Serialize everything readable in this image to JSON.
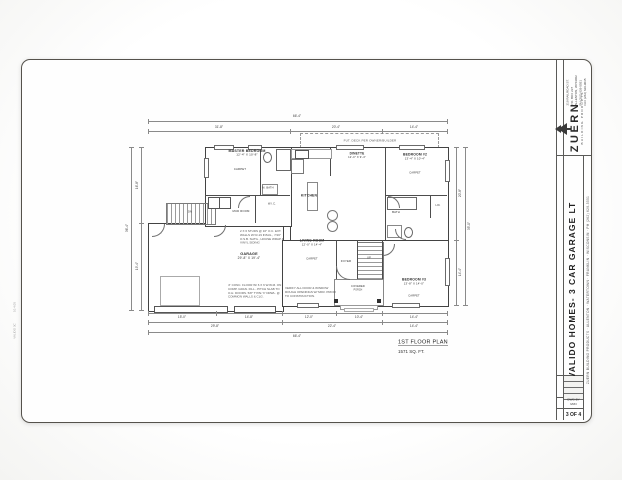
{
  "title_block": {
    "company": {
      "name": "ZUERN",
      "tagline": "BUILDING PRODUCTS",
      "address_lines": [
        "219 RAILROAD ST.",
        "P.O. BOX 237",
        "ALLENTON, WI 53002",
        "PH (262) 629-5551",
        "FAX (262) 629-9035"
      ]
    },
    "project_title": "VALIDO HOMES- 3 CAR GARAGE LT",
    "info_line": "ZUERN BUILDING PRODUCTS · ALLENTON · WATERTOWN · FRANKLIN · WISCONSIN · PH (262) 629-5551",
    "table_rows": [
      "DRAWN: MJN",
      "DATE: 8-05",
      "SCALE: 1/4\" = 1'-0\"",
      "JOB NO: 05-213"
    ],
    "dwg_by_label": "DWG BY",
    "dwg_by_value": "MJN",
    "sheet_number": "3 OF 4"
  },
  "edge_stamps": [
    {
      "text": "10.4.05",
      "x": 15,
      "y": 307
    },
    {
      "text": "VALIDO 3C",
      "x": 15,
      "y": 331
    }
  ],
  "plan": {
    "caption": {
      "title": "1ST FLOOR PLAN",
      "subtitle": "1571 SQ. FT."
    },
    "deck_label": "FUT. DECK PER OWNER/BUILDER",
    "outlines": [
      {
        "x": 148,
        "y": 223,
        "w": 134,
        "h": 87
      },
      {
        "x": 290,
        "y": 147,
        "w": 157,
        "h": 93
      },
      {
        "x": 282,
        "y": 240,
        "w": 165,
        "h": 65
      },
      {
        "x": 205,
        "y": 147,
        "w": 85,
        "h": 78
      }
    ],
    "walls": [
      {
        "x": 330,
        "y": 148,
        "w": 1,
        "h": 28
      },
      {
        "x": 385,
        "y": 148,
        "w": 1,
        "h": 92
      },
      {
        "x": 386,
        "y": 195,
        "w": 61,
        "h": 1
      },
      {
        "x": 430,
        "y": 196,
        "w": 1,
        "h": 22
      },
      {
        "x": 336,
        "y": 240,
        "w": 1,
        "h": 40
      },
      {
        "x": 357,
        "y": 240,
        "w": 1,
        "h": 40
      },
      {
        "x": 382,
        "y": 240,
        "w": 1,
        "h": 65
      },
      {
        "x": 205,
        "y": 195,
        "w": 85,
        "h": 1
      },
      {
        "x": 255,
        "y": 196,
        "w": 1,
        "h": 27
      },
      {
        "x": 260,
        "y": 148,
        "w": 1,
        "h": 47
      }
    ],
    "stairs": [
      {
        "x": 166,
        "y": 203,
        "w": 48,
        "h": 20,
        "dir": 90
      },
      {
        "x": 357,
        "y": 242,
        "w": 25,
        "h": 36,
        "dir": 0
      }
    ],
    "windows": [
      {
        "x": 214,
        "y": 145,
        "w": 18,
        "h": 3
      },
      {
        "x": 248,
        "y": 145,
        "w": 12,
        "h": 3
      },
      {
        "x": 336,
        "y": 145,
        "w": 26,
        "h": 3
      },
      {
        "x": 399,
        "y": 145,
        "w": 24,
        "h": 3
      },
      {
        "x": 445,
        "y": 160,
        "w": 3,
        "h": 20
      },
      {
        "x": 445,
        "y": 258,
        "w": 3,
        "h": 26
      },
      {
        "x": 297,
        "y": 303,
        "w": 20,
        "h": 3
      },
      {
        "x": 392,
        "y": 303,
        "w": 26,
        "h": 3
      },
      {
        "x": 204,
        "y": 158,
        "w": 3,
        "h": 18
      }
    ],
    "doors": [
      {
        "x": 152,
        "y": 224,
        "s": 12,
        "c": "br"
      },
      {
        "x": 336,
        "y": 266,
        "s": 13,
        "c": "bl"
      },
      {
        "x": 238,
        "y": 196,
        "s": 11,
        "c": "tl"
      },
      {
        "x": 388,
        "y": 196,
        "s": 11,
        "c": "tr"
      },
      {
        "x": 383,
        "y": 244,
        "s": 11,
        "c": "br"
      },
      {
        "x": 395,
        "y": 229,
        "s": 10,
        "c": "bl"
      },
      {
        "x": 214,
        "y": 225,
        "s": 11,
        "c": "br"
      }
    ],
    "fixtures": [
      {
        "k": "rect",
        "x": 291,
        "y": 149,
        "w": 39,
        "h": 8,
        "c": "#999"
      },
      {
        "k": "rect",
        "x": 295,
        "y": 150,
        "w": 12,
        "h": 7,
        "c": "#555"
      },
      {
        "k": "rect",
        "x": 291,
        "y": 159,
        "w": 11,
        "h": 13,
        "c": "#777"
      },
      {
        "k": "rect",
        "x": 307,
        "y": 182,
        "w": 9,
        "h": 27,
        "c": "#888"
      },
      {
        "k": "circ",
        "x": 327,
        "y": 210,
        "w": 9,
        "h": 9,
        "c": "#777"
      },
      {
        "k": "circ",
        "x": 327,
        "y": 221,
        "w": 9,
        "h": 9,
        "c": "#777"
      },
      {
        "k": "rect",
        "x": 276,
        "y": 149,
        "w": 13,
        "h": 20,
        "c": "#666"
      },
      {
        "k": "circ",
        "x": 263,
        "y": 152,
        "w": 7,
        "h": 9,
        "c": "#666"
      },
      {
        "k": "rect",
        "x": 262,
        "y": 184,
        "w": 14,
        "h": 9,
        "c": "#888"
      },
      {
        "k": "rect",
        "x": 387,
        "y": 197,
        "w": 28,
        "h": 11,
        "c": "#666"
      },
      {
        "k": "rect",
        "x": 387,
        "y": 225,
        "w": 13,
        "h": 11,
        "c": "#888"
      },
      {
        "k": "circ",
        "x": 404,
        "y": 227,
        "w": 7,
        "h": 9,
        "c": "#666"
      },
      {
        "k": "rect",
        "x": 208,
        "y": 197,
        "w": 10,
        "h": 10,
        "c": "#555"
      },
      {
        "k": "rect",
        "x": 219,
        "y": 197,
        "w": 10,
        "h": 10,
        "c": "#555"
      },
      {
        "k": "rect",
        "x": 160,
        "y": 276,
        "w": 38,
        "h": 28,
        "c": "#aaa"
      },
      {
        "k": "rect",
        "x": 334,
        "y": 279,
        "w": 48,
        "h": 25,
        "c": "#888"
      },
      {
        "k": "rect",
        "x": 340,
        "y": 305,
        "w": 36,
        "h": 3,
        "c": "#999"
      },
      {
        "k": "rect",
        "x": 344,
        "y": 308,
        "w": 28,
        "h": 2,
        "c": "#aaa"
      },
      {
        "k": "rect",
        "x": 154,
        "y": 306,
        "w": 72,
        "h": 5,
        "c": "#555"
      },
      {
        "k": "rect",
        "x": 234,
        "y": 306,
        "w": 40,
        "h": 5,
        "c": "#555"
      }
    ],
    "posts": [
      {
        "x": 334,
        "y": 299
      },
      {
        "x": 377,
        "y": 299
      }
    ],
    "labels": [
      {
        "x": 247,
        "y": 153,
        "fs": 3.6,
        "b": 1,
        "l": [
          "MASTER BEDROOM",
          "12'-4\" X 10'-8\""
        ]
      },
      {
        "x": 240,
        "y": 170,
        "fs": 2.8,
        "l": [
          "CARPET"
        ]
      },
      {
        "x": 268,
        "y": 188,
        "fs": 2.6,
        "l": [
          "M. BATH"
        ]
      },
      {
        "x": 272,
        "y": 204,
        "fs": 2.6,
        "l": [
          "W.I.C."
        ]
      },
      {
        "x": 241,
        "y": 212,
        "fs": 2.8,
        "l": [
          "MUD ROOM"
        ]
      },
      {
        "x": 309,
        "y": 196,
        "fs": 3.4,
        "b": 1,
        "l": [
          "KITCHEN"
        ]
      },
      {
        "x": 357,
        "y": 156,
        "fs": 3.2,
        "b": 1,
        "l": [
          "DINETTE",
          "12'-0\" X 9'-4\""
        ]
      },
      {
        "x": 415,
        "y": 157,
        "fs": 3.4,
        "b": 1,
        "l": [
          "BEDROOM #2",
          "13'-4\" X 10'-4\""
        ]
      },
      {
        "x": 415,
        "y": 173,
        "fs": 2.6,
        "l": [
          "CARPET"
        ]
      },
      {
        "x": 396,
        "y": 213,
        "fs": 2.8,
        "l": [
          "BATH"
        ]
      },
      {
        "x": 438,
        "y": 206,
        "fs": 2.4,
        "l": [
          "LIN."
        ]
      },
      {
        "x": 312,
        "y": 243,
        "fs": 3.4,
        "b": 1,
        "l": [
          "LIVING ROOM",
          "12'-0\" X 14'-4\""
        ]
      },
      {
        "x": 312,
        "y": 259,
        "fs": 2.6,
        "l": [
          "CARPET"
        ]
      },
      {
        "x": 346,
        "y": 262,
        "fs": 2.8,
        "l": [
          "FOYER"
        ]
      },
      {
        "x": 369,
        "y": 258,
        "fs": 2.6,
        "l": [
          "UP"
        ]
      },
      {
        "x": 414,
        "y": 282,
        "fs": 3.4,
        "b": 1,
        "l": [
          "BEDROOM #3",
          "13'-8\" X 14'-0\""
        ]
      },
      {
        "x": 414,
        "y": 296,
        "fs": 2.6,
        "l": [
          "CARPET"
        ]
      },
      {
        "x": 358,
        "y": 288,
        "fs": 2.6,
        "l": [
          "COVERED",
          "PORCH"
        ]
      },
      {
        "x": 249,
        "y": 256,
        "fs": 3.8,
        "b": 1,
        "l": [
          "GARAGE",
          "29'-8\" X 19'-4\""
        ]
      },
      {
        "x": 190,
        "y": 212,
        "fs": 2.6,
        "l": [
          "DN"
        ]
      }
    ],
    "notes": [
      {
        "x": 240,
        "y": 230,
        "w": 44,
        "t": "2 X 6 STUDS @ 16\" O.C. EXT. WALLS W/ R-19 INSUL., 7/16\" O.S.B. SHTG., HOUSE WRAP & VINYL SIDING"
      },
      {
        "x": 228,
        "y": 284,
        "w": 54,
        "t": "4\" CONC. FLOOR W/ 6 X 6 W.W.M. ON COMP. GRAN. FILL - PITCH SLAB TO O.H. DOORS. 5/8\" TYPE 'X' DRWL. @ COMMON WALLS & CLG."
      },
      {
        "x": 285,
        "y": 287,
        "w": 52,
        "t": "VERIFY ALL DOOR & WINDOW ROUGH OPENINGS W/ MFR. PRIOR TO CONSTRUCTION."
      }
    ],
    "dims": [
      {
        "o": "h",
        "a": 148,
        "b": 447,
        "p": 121,
        "t": "66'-4\"",
        "lx": 297,
        "ly": 116
      },
      {
        "o": "h",
        "a": 148,
        "b": 290,
        "p": 131,
        "t": "31'-8\"",
        "lx": 219,
        "ly": 127
      },
      {
        "o": "h",
        "a": 290,
        "b": 382,
        "p": 131,
        "t": "20'-4\"",
        "lx": 336,
        "ly": 127
      },
      {
        "o": "h",
        "a": 382,
        "b": 447,
        "p": 131,
        "t": "14'-4\"",
        "lx": 414,
        "ly": 127
      },
      {
        "o": "h",
        "a": 148,
        "b": 216,
        "p": 313,
        "t": "15'-0\"",
        "lx": 182,
        "ly": 317
      },
      {
        "o": "h",
        "a": 216,
        "b": 282,
        "p": 313,
        "t": "14'-8\"",
        "lx": 249,
        "ly": 317
      },
      {
        "o": "h",
        "a": 282,
        "b": 336,
        "p": 313,
        "t": "12'-0\"",
        "lx": 309,
        "ly": 317
      },
      {
        "o": "h",
        "a": 336,
        "b": 382,
        "p": 313,
        "t": "10'-4\"",
        "lx": 359,
        "ly": 317
      },
      {
        "o": "h",
        "a": 382,
        "b": 447,
        "p": 313,
        "t": "14'-4\"",
        "lx": 414,
        "ly": 317
      },
      {
        "o": "h",
        "a": 148,
        "b": 282,
        "p": 322,
        "t": "29'-8\"",
        "lx": 215,
        "ly": 326
      },
      {
        "o": "h",
        "a": 282,
        "b": 382,
        "p": 322,
        "t": "22'-4\"",
        "lx": 332,
        "ly": 326
      },
      {
        "o": "h",
        "a": 382,
        "b": 447,
        "p": 322,
        "t": "14'-4\"",
        "lx": 414,
        "ly": 326
      },
      {
        "o": "h",
        "a": 148,
        "b": 447,
        "p": 332,
        "t": "66'-4\"",
        "lx": 297,
        "ly": 336
      },
      {
        "o": "v",
        "a": 147,
        "b": 223,
        "p": 141,
        "t": "16'-8\"",
        "lx": 137,
        "ly": 185
      },
      {
        "o": "v",
        "a": 223,
        "b": 310,
        "p": 141,
        "t": "19'-4\"",
        "lx": 137,
        "ly": 266
      },
      {
        "o": "v",
        "a": 147,
        "b": 310,
        "p": 131,
        "t": "36'-4\"",
        "lx": 127,
        "ly": 228
      },
      {
        "o": "v",
        "a": 147,
        "b": 240,
        "p": 456,
        "t": "20'-8\"",
        "lx": 460,
        "ly": 193
      },
      {
        "o": "v",
        "a": 240,
        "b": 305,
        "p": 456,
        "t": "14'-4\"",
        "lx": 460,
        "ly": 272
      },
      {
        "o": "v",
        "a": 147,
        "b": 305,
        "p": 465,
        "t": "35'-0\"",
        "lx": 469,
        "ly": 226
      }
    ]
  }
}
